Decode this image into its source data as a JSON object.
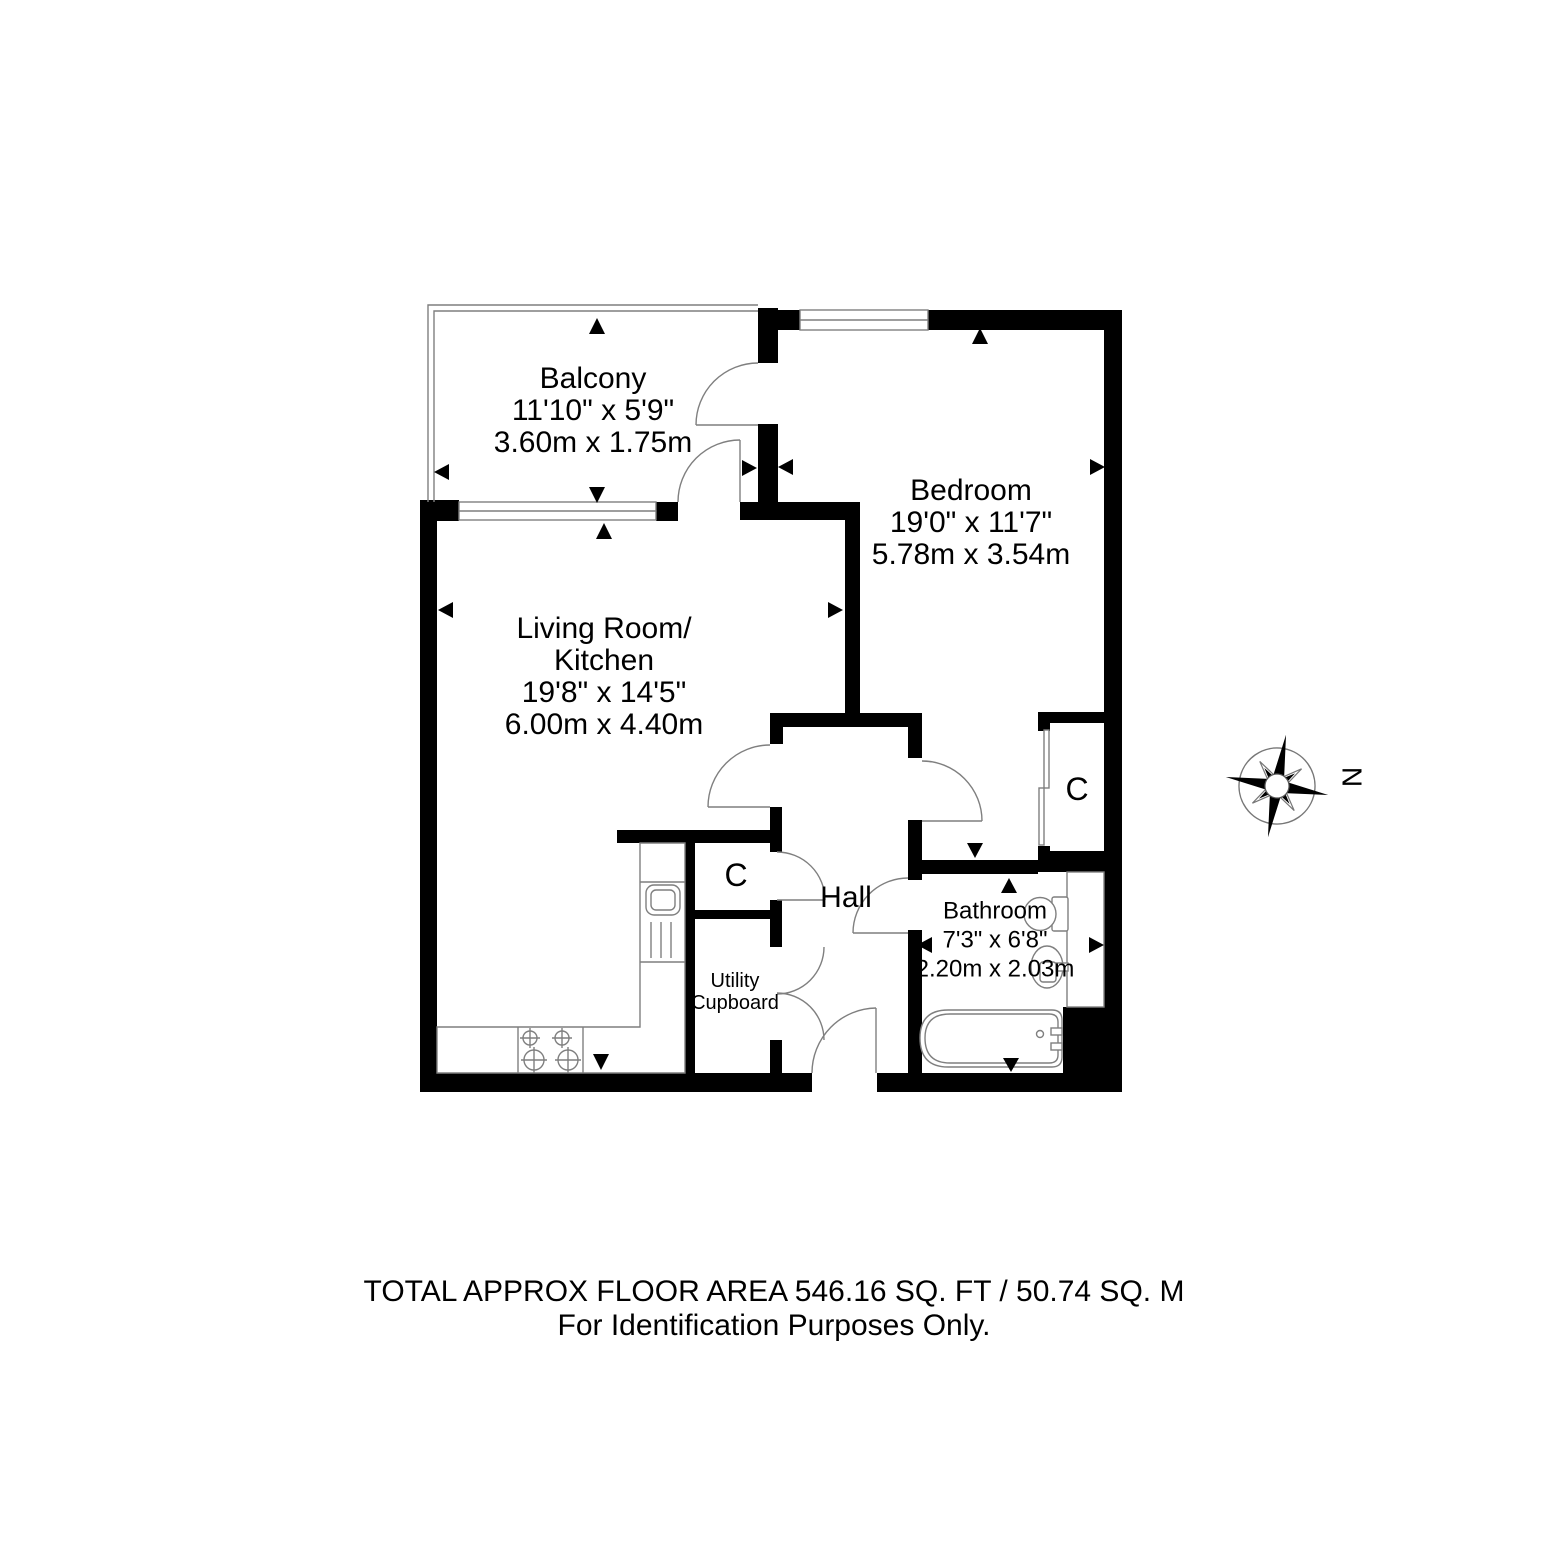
{
  "page": {
    "background": "#ffffff",
    "wall_color": "#000000",
    "line_color": "#7f7f7f"
  },
  "rooms": {
    "balcony": {
      "name": "Balcony",
      "imperial": "11'10\" x 5'9\"",
      "metric": "3.60m x 1.75m"
    },
    "living_kitchen": {
      "name_line1": "Living Room/",
      "name_line2": "Kitchen",
      "imperial": "19'8\" x 14'5\"",
      "metric": "6.00m x 4.40m"
    },
    "bedroom": {
      "name": "Bedroom",
      "imperial": "19'0\" x 11'7\"",
      "metric": "5.78m x 3.54m"
    },
    "bathroom": {
      "name": "Bathroom",
      "imperial": "7'3\" x 6'8\"",
      "metric": "2.20m x 2.03m"
    },
    "hall": {
      "name": "Hall"
    },
    "cupboard_hall": {
      "name": "C"
    },
    "cupboard_bedroom": {
      "name": "C"
    },
    "utility": {
      "name_line1": "Utility",
      "name_line2": "Cupboard"
    }
  },
  "compass": {
    "label": "N"
  },
  "footer": {
    "line1": "TOTAL APPROX FLOOR AREA 546.16 SQ. FT / 50.74 SQ. M",
    "line2": "For Identification Purposes Only."
  }
}
